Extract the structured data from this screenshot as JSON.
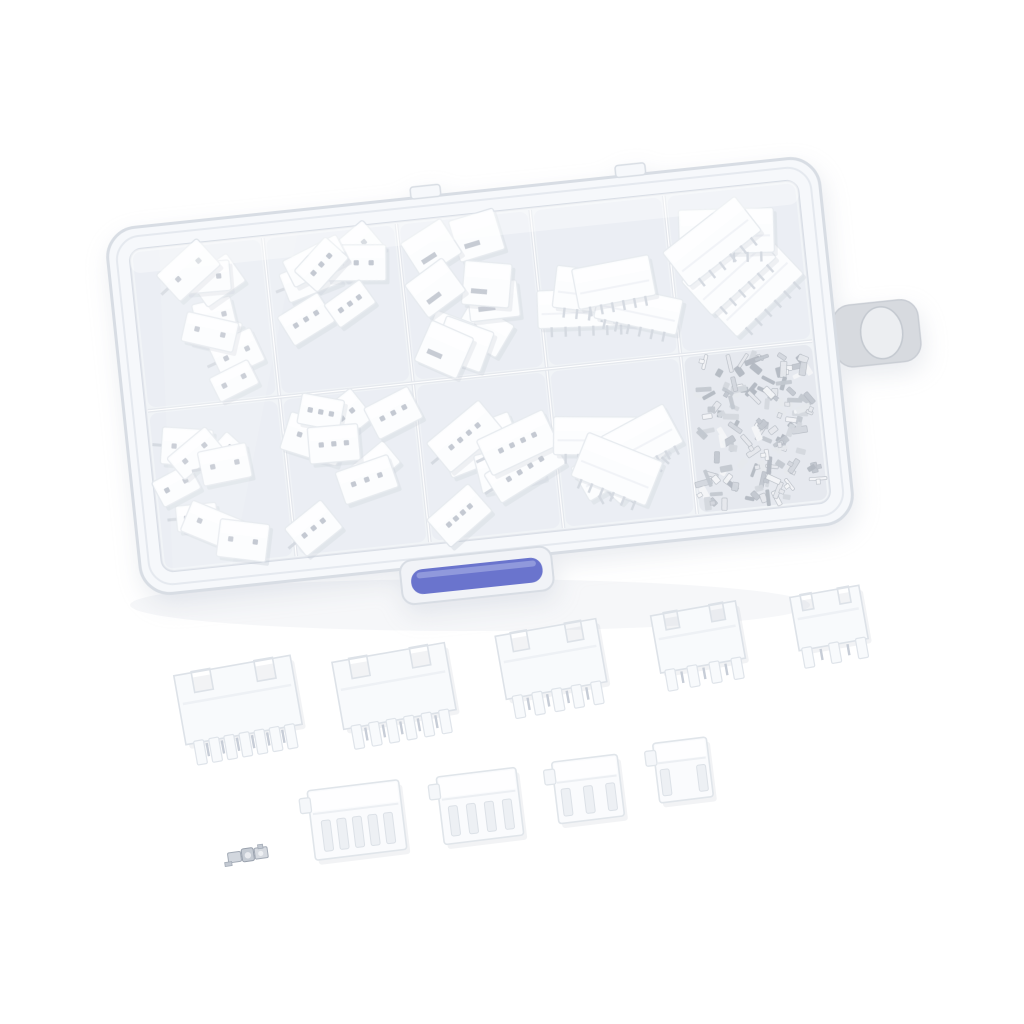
{
  "scene": {
    "type": "product-photo",
    "subject": "JST-style connector assortment kit in a clear plastic organizer box with metal crimp terminals",
    "background": "#ffffff"
  },
  "palette": {
    "plastic_shell": "#f6f8fb",
    "plastic_edge": "#d8dde4",
    "plastic_rim": "#e5e9ef",
    "interior": "#edf0f5",
    "floor": "#e4e9f0",
    "floor_dark": "#dde2ea",
    "divider": "#d9dee6",
    "piece_fill": "#fbfcfe",
    "piece_stroke": "#dfe4ea",
    "piece_shadow": "#b6bdc9",
    "dot": "#b0b7c3",
    "pin_metal": "#c7cdd7",
    "terminal_shades": [
      "#f0f2f5",
      "#dde1e7",
      "#c5cad3",
      "#aeb5c0",
      "#99a1ad"
    ],
    "latch_blue": "#6a74cd",
    "latch_blue_highlight": "#9aa2e0",
    "tab_fill": "#d7dadf",
    "tab_hole": "#eceef1"
  },
  "box": {
    "rotation_deg": -6,
    "cx": 480,
    "cy": 376,
    "outer": {
      "x": 122,
      "y": 192,
      "w": 716,
      "h": 368,
      "rx": 30
    },
    "rim": {
      "x": 131,
      "y": 201,
      "w": 698,
      "h": 350,
      "rx": 24
    },
    "interior": {
      "x": 144,
      "y": 214,
      "w": 672,
      "h": 324,
      "rx": 12
    },
    "columns": 5,
    "rows": 2,
    "hinge_bumps": [
      {
        "x": 430,
        "y": 181,
        "w": 30,
        "h": 12
      },
      {
        "x": 636,
        "y": 181,
        "w": 30,
        "h": 12
      }
    ],
    "side_tab": {
      "x": 836,
      "y": 344,
      "w": 86,
      "h": 62,
      "rx": 18,
      "hole": {
        "cx": 884,
        "cy": 375,
        "rx": 21,
        "ry": 26
      }
    },
    "latch": {
      "frame": {
        "x": 380,
        "y": 552,
        "w": 152,
        "h": 44,
        "rx": 12
      },
      "bar": {
        "x": 390,
        "y": 562,
        "w": 132,
        "h": 25,
        "rx": 12
      }
    }
  },
  "compartments": [
    {
      "id": "r1c1",
      "row": 0,
      "col": 0,
      "style": "dots",
      "dots": 2,
      "count": 8,
      "w": [
        38,
        58
      ],
      "h": [
        26,
        38
      ],
      "seed": 11
    },
    {
      "id": "r1c2",
      "row": 0,
      "col": 1,
      "style": "dots",
      "dots": 3,
      "count": 7,
      "w": [
        44,
        64
      ],
      "h": [
        28,
        40
      ],
      "seed": 22
    },
    {
      "id": "r1c3",
      "row": 0,
      "col": 2,
      "style": "wafer",
      "dots": 0,
      "count": 9,
      "w": [
        40,
        52
      ],
      "h": [
        34,
        46
      ],
      "seed": 33
    },
    {
      "id": "r1c4",
      "row": 0,
      "col": 3,
      "style": "header",
      "dots": 0,
      "count": 4,
      "w": [
        78,
        100
      ],
      "h": [
        36,
        48
      ],
      "seed": 44
    },
    {
      "id": "r1c5",
      "row": 0,
      "col": 4,
      "style": "header",
      "dots": 0,
      "count": 4,
      "w": [
        82,
        104
      ],
      "h": [
        40,
        52
      ],
      "seed": 55
    },
    {
      "id": "r2c1",
      "row": 1,
      "col": 0,
      "style": "dots",
      "dots": 2,
      "count": 8,
      "w": [
        38,
        58
      ],
      "h": [
        26,
        38
      ],
      "seed": 66
    },
    {
      "id": "r2c2",
      "row": 1,
      "col": 1,
      "style": "dots",
      "dots": 3,
      "count": 8,
      "w": [
        40,
        62
      ],
      "h": [
        28,
        42
      ],
      "seed": 77
    },
    {
      "id": "r2c3",
      "row": 1,
      "col": 2,
      "style": "dots",
      "dots": 4,
      "count": 6,
      "w": [
        55,
        80
      ],
      "h": [
        34,
        46
      ],
      "seed": 88
    },
    {
      "id": "r2c4",
      "row": 1,
      "col": 3,
      "style": "header",
      "dots": 0,
      "count": 5,
      "w": [
        66,
        92
      ],
      "h": [
        38,
        50
      ],
      "seed": 99
    },
    {
      "id": "r2c5",
      "row": 1,
      "col": 4,
      "style": "terminals",
      "count": 130,
      "seed": 123
    }
  ],
  "loose_headers": [
    {
      "cx": 238,
      "cy": 700,
      "w": 118,
      "h": 70,
      "rot": -10,
      "pins": 7
    },
    {
      "cx": 394,
      "cy": 686,
      "w": 114,
      "h": 68,
      "rot": -10,
      "pins": 6
    },
    {
      "cx": 551,
      "cy": 659,
      "w": 102,
      "h": 64,
      "rot": -10,
      "pins": 5
    },
    {
      "cx": 698,
      "cy": 637,
      "w": 86,
      "h": 58,
      "rot": -10,
      "pins": 4
    },
    {
      "cx": 829,
      "cy": 618,
      "w": 70,
      "h": 54,
      "rot": -10,
      "pins": 3
    }
  ],
  "loose_housings": [
    {
      "cx": 357,
      "cy": 820,
      "w": 92,
      "h": 70,
      "rot": -7,
      "slots": 5
    },
    {
      "cx": 480,
      "cy": 806,
      "w": 80,
      "h": 68,
      "rot": -7,
      "slots": 4
    },
    {
      "cx": 588,
      "cy": 789,
      "w": 66,
      "h": 62,
      "rot": -7,
      "slots": 3
    },
    {
      "cx": 683,
      "cy": 770,
      "w": 54,
      "h": 60,
      "rot": -7,
      "slots": 2
    }
  ],
  "loose_terminal": {
    "cx": 250,
    "cy": 856,
    "rot": -8
  }
}
